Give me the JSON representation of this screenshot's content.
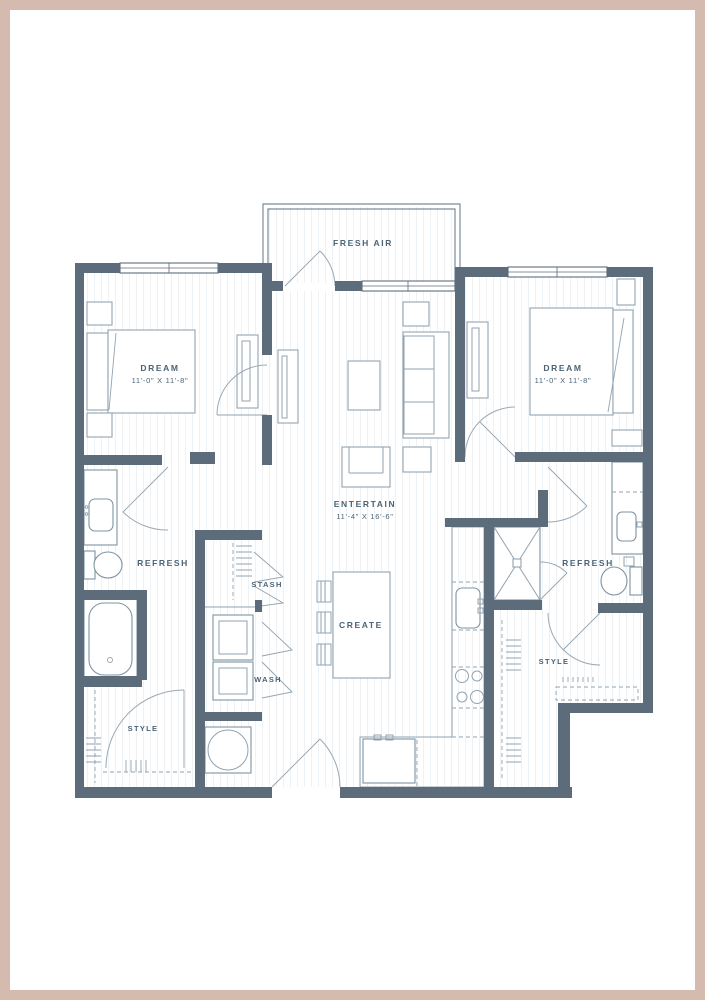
{
  "palette": {
    "pink_border": "#d5bbaf",
    "wall": "#5d6c7b",
    "furniture_line": "#93a3b0",
    "fixture_line": "#7f93a2",
    "label": "#4a6375",
    "floor_line": "#eef2f4",
    "background": "#ffffff"
  },
  "plan": {
    "balcony": {
      "label": "FRESH AIR"
    },
    "rooms": [
      {
        "id": "bedroom-left",
        "label": "DREAM",
        "dims": "11'-0\" X 11'-8\""
      },
      {
        "id": "bedroom-right",
        "label": "DREAM",
        "dims": "11'-0\" X 11'-8\""
      },
      {
        "id": "living",
        "label": "ENTERTAIN",
        "dims": "11'-4\" X 16'-6\""
      },
      {
        "id": "bath-left",
        "label": "REFRESH"
      },
      {
        "id": "closet-stash",
        "label": "STASH"
      },
      {
        "id": "kitchen",
        "label": "CREATE"
      },
      {
        "id": "laundry",
        "label": "WASH"
      },
      {
        "id": "closet-left",
        "label": "STYLE"
      },
      {
        "id": "bath-right",
        "label": "REFRESH"
      },
      {
        "id": "closet-right",
        "label": "STYLE"
      }
    ]
  }
}
